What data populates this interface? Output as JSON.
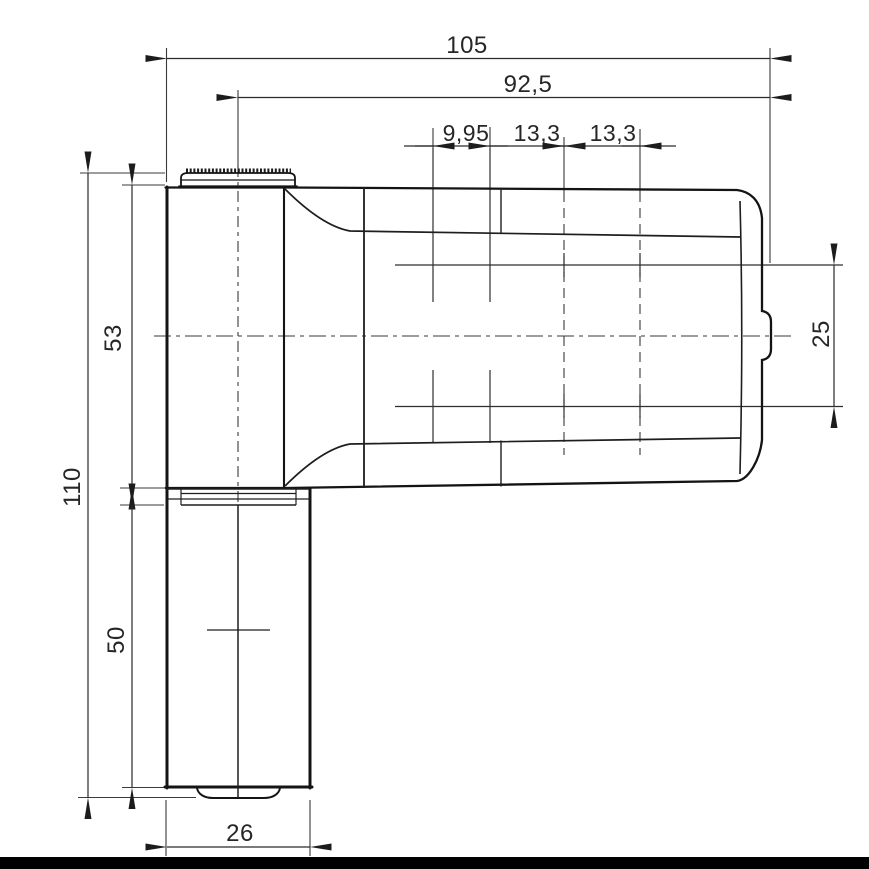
{
  "drawing": {
    "subject": "door-hinge-technical-drawing",
    "dimensions": {
      "overall_width": "105",
      "width_from_axis": "92,5",
      "hole_offset": "9,95",
      "hole_pitch_a": "13,3",
      "hole_pitch_b": "13,3",
      "overall_height": "110",
      "upper_knuckle_height": "53",
      "lower_knuckle_height": "50",
      "hole_row_spacing": "25",
      "knuckle_width": "26"
    },
    "colors": {
      "outline": "#141414",
      "detail_line": "#2e2e2e",
      "thin_line": "#3a3a3a",
      "background": "#ffffff",
      "footer_bar": "#000000"
    }
  }
}
